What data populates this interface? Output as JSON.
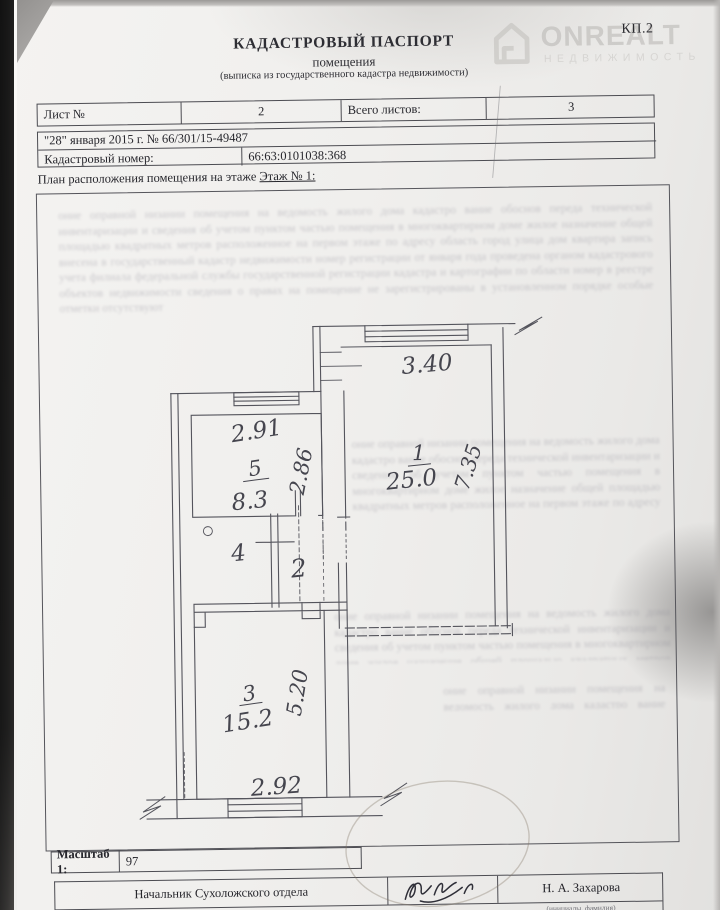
{
  "page": {
    "form_code": "КП.2"
  },
  "watermark": {
    "brand": "ONREALT",
    "subtitle": "НЕДВИЖИМОСТЬ"
  },
  "header": {
    "title": "КАДАСТРОВЫЙ ПАСПОРТ",
    "subtitle": "помещения",
    "note": "(выписка из государственного кадастра недвижимости)"
  },
  "sheet_table": {
    "sheet_label": "Лист №",
    "sheet_value": "2",
    "total_label": "Всего листов:",
    "total_value": "3"
  },
  "doc_info": {
    "date_line": "\"28\" января 2015 г. № 66/301/15-49487",
    "cadastral_label": "Кадастровый номер:",
    "cadastral_value": "66:63:0101038:368"
  },
  "plan": {
    "caption": "План расположения помещения на этаже ",
    "floor": "Этаж № 1:"
  },
  "floor_plan": {
    "rooms": {
      "room1": {
        "number": "1",
        "area": "25.0"
      },
      "room2": {
        "number": "2"
      },
      "room3": {
        "number": "3",
        "area": "15.2"
      },
      "room4": {
        "number": "4"
      },
      "room5": {
        "number": "5",
        "area": "8.3"
      }
    },
    "dimensions": {
      "top_wall": "3.40",
      "right_wall": "7.35",
      "kitchen_width": "2.91",
      "kitchen_depth": "2.86",
      "room3_depth": "5.20",
      "room3_width": "2.92"
    }
  },
  "scale": {
    "label": "Масштаб 1:",
    "value": "97"
  },
  "signature": {
    "position": "Начальник Сухоложского отдела",
    "name": "Н. А. Захарова",
    "hint": "(инициалы, фамилия)"
  },
  "artifacts": {
    "ghost_text": "оние оправной низании помещения на ведомость жилого дома кадастро вание обоснов переда технической инвентаризации и сведения об учетом пунктом частью помещения в многоквартирном доме жилое назначение общей площадью квадратных метров расположенное на первом этаже по адресу область город улица дом квартира запись внесена в государственный кадастр недвижимости номер регистрации от января года проведена органом кадастрового учета филиала федеральной службы государственной регистрации кадастра и картографии по области номер в реестре объектов недвижимости сведения о правах на помещение не зарегистрированы в установленном порядке особые отметки отсутствуют"
  }
}
